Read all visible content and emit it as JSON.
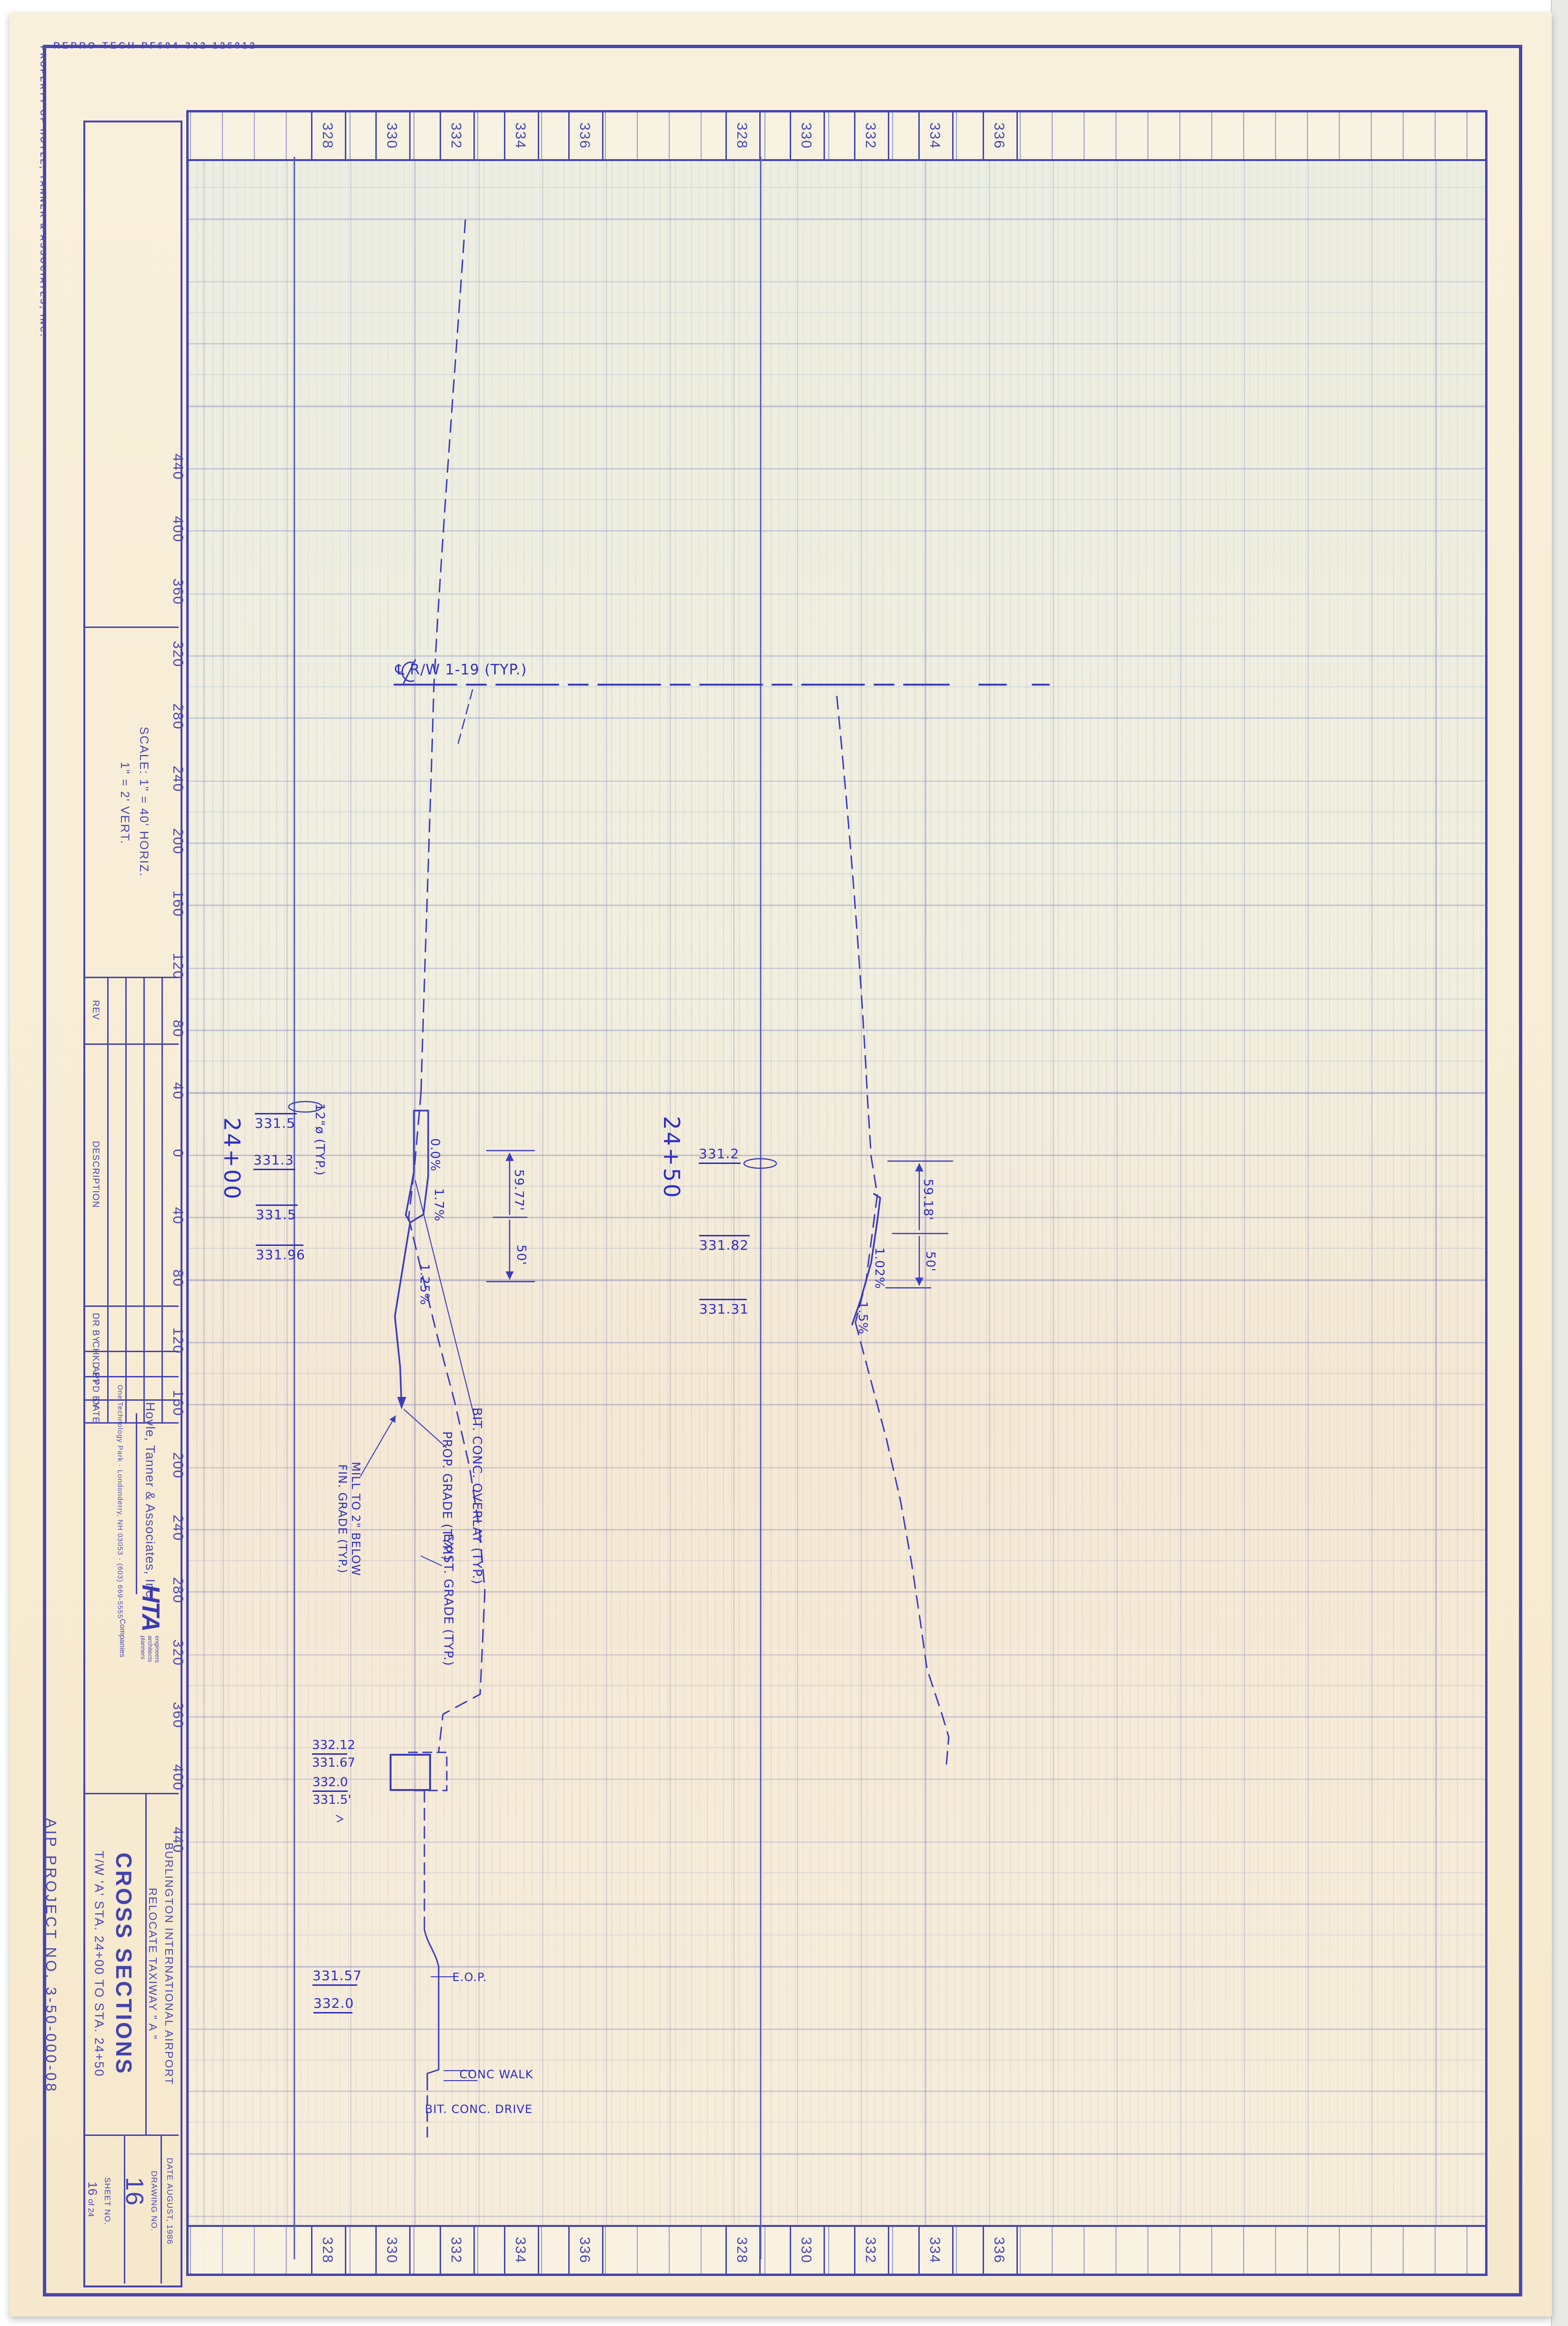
{
  "stamps": {
    "repro": "REPRO TECH   PF604-332  126012",
    "property": "PROPERTY OF HOYLE, TANNER & ASSOCIATES, INC.",
    "aip": "AIP PROJECT NO. 3-50-000-08"
  },
  "titleblock": {
    "scale_line1": "SCALE:  1\" = 40' HORIZ.",
    "scale_line2": "1\" =  2'  VERT.",
    "rev_headers": [
      "REV",
      "DESCRIPTION",
      "DR BY",
      "CHKD BY",
      "APPD BY",
      "DATE"
    ],
    "company": {
      "name": "Hoyle, Tanner & Associates, Inc.",
      "address": "One Technology Park ·  Londonderry, NH 03053 ·  (603) 669-5555",
      "logo": "HTA",
      "logo_tags": [
        "engineers",
        "architects",
        "planners"
      ],
      "companies": "Companies"
    },
    "project": {
      "airport": "BURLINGTON  INTERNATIONAL  AIRPORT",
      "relocate": "RELOCATE  TAXIWAY  \" A \"",
      "title": "CROSS  SECTIONS",
      "subtitle": "T/W 'A' STA. 24+00 TO STA. 24+50"
    },
    "date_label": "DATE",
    "date_value": "AUGUST, 1986",
    "drawing_label": "DRAWING  NO.",
    "drawing_value": "16",
    "sheet_label": "SHEET  NO.",
    "sheet_value": "16",
    "sheet_of": "of 24"
  },
  "axes": {
    "elevations": [
      "328",
      "330",
      "332",
      "334",
      "336"
    ],
    "offsets": [
      "440",
      "400",
      "360",
      "320",
      "280",
      "240",
      "200",
      "160",
      "120",
      "80",
      "40",
      "0",
      "40",
      "80",
      "120",
      "160",
      "200",
      "240",
      "280",
      "320",
      "360",
      "400",
      "440"
    ]
  },
  "annotations": {
    "rw_label": "℄  R/W  1-19  (TYP.)",
    "sta_2400": "24+00",
    "sta_2450": "24+50",
    "pipe_2400": "12\"ø (TYP.)",
    "slope_2400_a": "0.0%",
    "slope_2400_b": "1.7%",
    "slope_2400_c": "1.25%",
    "dim_2400_a": "59.77'",
    "dim_2400_b": "50'",
    "slope_2450_a": "1.02%",
    "slope_2450_b": "1.5%",
    "dim_2450_a": "59.18'",
    "dim_2450_b": "50'",
    "note_overlay": "BIT. CONC. OVERLAY (TYP.)",
    "note_prop": "PROP. GRADE (TYP.)",
    "note_mill": "MILL TO 2\" BELOW\nFIN. GRADE (TYP.)",
    "note_exist": "EXIST. GRADE (TYP.)",
    "note_eop": "E.O.P.",
    "note_walk": "CONC WALK",
    "note_drive": "BIT. CONC. DRIVE"
  },
  "elev_tags": [
    {
      "id": "el2400_1",
      "text": "331.5",
      "bar": "over"
    },
    {
      "id": "el2400_2",
      "text": "331.3",
      "bar": "under"
    },
    {
      "id": "el2400_3",
      "text": "331.5",
      "bar": "over"
    },
    {
      "id": "el2400_4",
      "text": "331.96",
      "bar": "over"
    },
    {
      "id": "el2450_1",
      "text": "331.2",
      "bar": "under"
    },
    {
      "id": "el2450_2",
      "text": "331.82",
      "bar": "over"
    },
    {
      "id": "el2450_3",
      "text": "331.31",
      "bar": "over"
    },
    {
      "id": "road_1",
      "text": "331.57",
      "bar": "under"
    },
    {
      "id": "road_2",
      "text": "332.0",
      "bar": "under"
    }
  ],
  "stacked_tags": [
    {
      "id": "culv_1",
      "top": "332.12",
      "bottom": "331.67"
    },
    {
      "id": "culv_2",
      "top": "332.0",
      "bottom": "331.5'"
    }
  ]
}
